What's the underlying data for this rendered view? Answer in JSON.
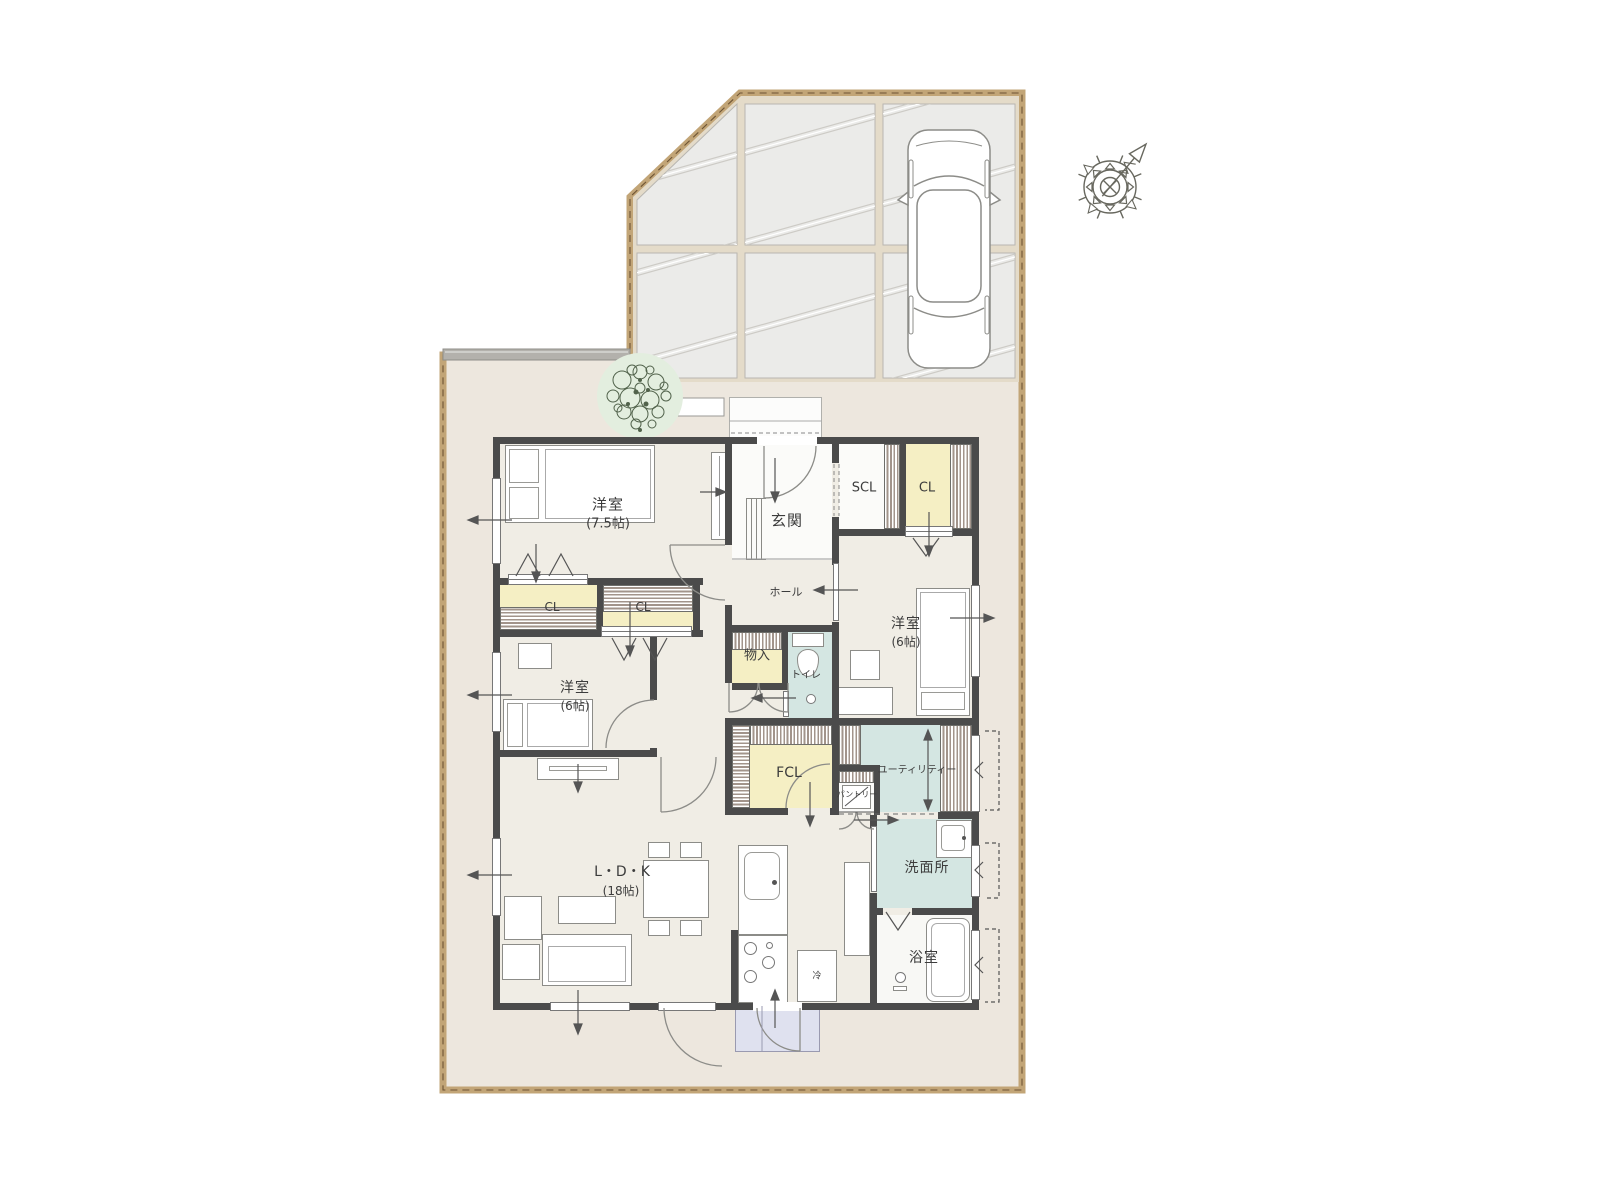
{
  "title": "間取り図",
  "rooms": {
    "bedroom75": {
      "label": "洋室",
      "size": "(7.5帖)"
    },
    "bedroom6l": {
      "label": "洋室",
      "size": "(6帖)"
    },
    "bedroom6r": {
      "label": "洋室",
      "size": "(6帖)"
    },
    "ldk": {
      "label": "L・D・K",
      "size": "(18帖)"
    },
    "genkan": {
      "label": "玄関"
    },
    "hall": {
      "label": "ホール"
    },
    "scl": {
      "label": "SCL"
    },
    "cl_entry": {
      "label": "CL"
    },
    "cl_a": {
      "label": "CL"
    },
    "cl_b": {
      "label": "CL"
    },
    "monoire": {
      "label": "物入"
    },
    "toilet": {
      "label": "トイレ"
    },
    "fcl": {
      "label": "FCL"
    },
    "pantry": {
      "label": "パントリー"
    },
    "utility": {
      "label": "ユーティリティー"
    },
    "washroom": {
      "label": "洗面所"
    },
    "bathroom": {
      "label": "浴室"
    },
    "kitchen": {
      "fridge_label": "冷"
    }
  },
  "colors": {
    "wall": "#4B4B4B",
    "floor": "#F0EDE5",
    "closet_yellow": "#F5EFC4",
    "wet_blue": "#D4E6E2",
    "tile_white": "#FBFBF9",
    "yard": "#EDE7DE",
    "boundary": "#C2A577",
    "driveway_slab": "#EBEBE9",
    "driveway_joint": "#E4DBC9",
    "entry_step": "#DFE1EF"
  },
  "icons": {
    "compass": "compass-icon",
    "tree": "tree-icon",
    "car": "car-icon"
  }
}
